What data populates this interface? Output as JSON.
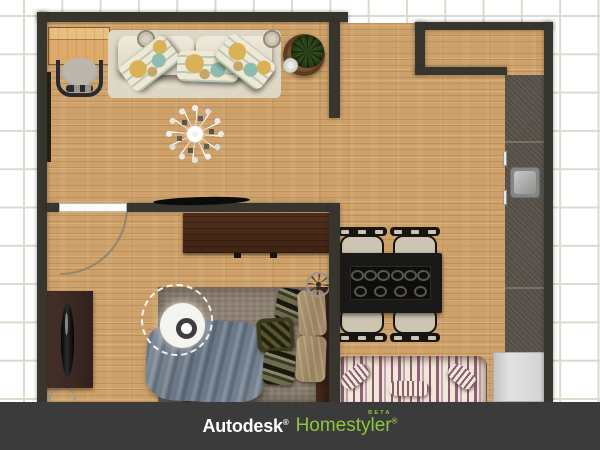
{
  "theme": {
    "grid_line": "#dadacd",
    "wall": "#36362e",
    "floor": "#cda169",
    "counter": "#59524b",
    "bar": "#3b3b3b",
    "green": "#8dc63f",
    "white": "#ffffff"
  },
  "footer": {
    "autodesk": "Autodesk",
    "homestyler": "Homestyler",
    "reg_mark": "®",
    "beta_label": "BETA"
  },
  "scene": {
    "selected_object": "ceiling-lamp",
    "objects": [
      "desk",
      "desk-chair",
      "sofa",
      "throw-pillows",
      "side-table",
      "plant",
      "chandelier",
      "wall-tv",
      "door",
      "dresser",
      "tv-console",
      "television",
      "bed",
      "blanket",
      "bed-pillows",
      "ceiling-lamp",
      "table-fan",
      "dining-table",
      "dining-chair",
      "striped-sofa",
      "kitchen-counter",
      "sink",
      "refrigerator",
      "stool"
    ]
  }
}
